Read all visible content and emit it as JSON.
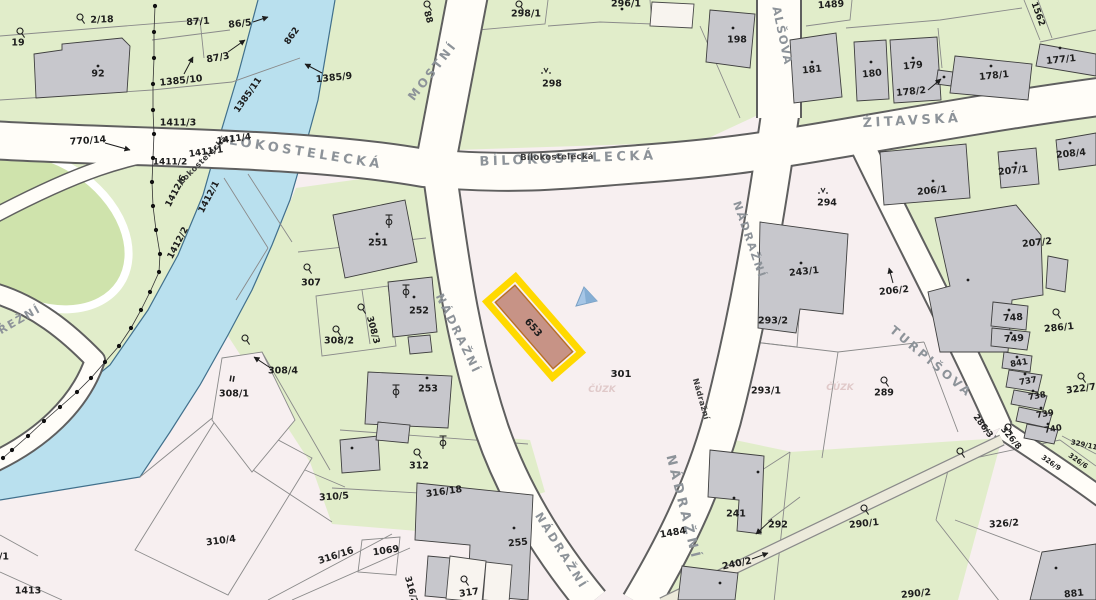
{
  "map": {
    "colors": {
      "background": "#f7eff0",
      "water": "#b9e0ee",
      "water_edge": "#41708c",
      "green_area": "#e1edca",
      "park_green": "#cfe3ac",
      "road_fill": "#fffdf8",
      "road_casing": "#5f5f5f",
      "building_gray": "#c7c7cc",
      "highlight_yellow": "#ffd900",
      "highlight_border": "#b86f28",
      "highlight_fill": "#c79386",
      "marker_blue": "#a6c6e6",
      "street_label": "#8d9399",
      "parcel_label": "#1d1d1d",
      "strip_fill": "#eceadb"
    },
    "highlight": {
      "label": "653",
      "x": 534,
      "y": 327,
      "rot": 49
    },
    "marker": {
      "x": 585,
      "y": 296
    },
    "streets": [
      {
        "text": "LOKOSTELECKÁ",
        "x": 306,
        "y": 153,
        "rot": 9,
        "size": 13,
        "sp": 3.5
      },
      {
        "text": "Lokostelecká",
        "x": 203,
        "y": 160,
        "rot": -45,
        "size": 8,
        "sp": 0.5,
        "dark": true
      },
      {
        "text": "BÍLOKOSTELECKÁ",
        "x": 568,
        "y": 159,
        "rot": -2,
        "size": 13,
        "sp": 3.5
      },
      {
        "text": "Bílokostelecká",
        "x": 557,
        "y": 157,
        "rot": -1,
        "size": 8.5,
        "sp": 0.3,
        "dark": true
      },
      {
        "text": "ŽITAVSKÁ",
        "x": 912,
        "y": 121,
        "rot": -3,
        "size": 13,
        "sp": 3.5
      },
      {
        "text": "MOSTNÍ",
        "x": 433,
        "y": 71,
        "rot": -52,
        "size": 12,
        "sp": 3
      },
      {
        "text": "NÁDRAŽNÍ",
        "x": 458,
        "y": 334,
        "rot": 64,
        "size": 11.5,
        "sp": 2.5
      },
      {
        "text": "NÁDRAŽNÍ",
        "x": 561,
        "y": 551,
        "rot": 58,
        "size": 11.5,
        "sp": 2.5
      },
      {
        "text": "NÁDRAŽNÍ",
        "x": 749,
        "y": 240,
        "rot": 71,
        "size": 11,
        "sp": 2
      },
      {
        "text": "NÁDRAŽNÍ",
        "x": 683,
        "y": 508,
        "rot": 76,
        "size": 13,
        "sp": 4
      },
      {
        "text": "Nádražní",
        "x": 701,
        "y": 399,
        "rot": 74,
        "size": 8,
        "sp": 0.3,
        "dark": true
      },
      {
        "text": "ALŠOVA",
        "x": 782,
        "y": 36,
        "rot": 78,
        "size": 11.5,
        "sp": 1.5
      },
      {
        "text": "TURPIŠOVA",
        "x": 931,
        "y": 362,
        "rot": 40,
        "size": 12,
        "sp": 3
      },
      {
        "text": "ŘEŽNÍ",
        "x": 20,
        "y": 320,
        "rot": -30,
        "size": 11,
        "sp": 2
      }
    ],
    "parcel_labels": [
      {
        "text": "2/18",
        "x": 102,
        "y": 20,
        "rot": -2
      },
      {
        "text": "19",
        "x": 18,
        "y": 43,
        "rot": 0
      },
      {
        "text": "92",
        "x": 98,
        "y": 74,
        "rot": 0
      },
      {
        "text": "87/1",
        "x": 198,
        "y": 22,
        "rot": -4
      },
      {
        "text": "86/5",
        "x": 240,
        "y": 24,
        "rot": -6
      },
      {
        "text": "87/3",
        "x": 218,
        "y": 58,
        "rot": -10
      },
      {
        "text": "1385/10",
        "x": 181,
        "y": 81,
        "rot": -6
      },
      {
        "text": "862",
        "x": 292,
        "y": 36,
        "rot": -55,
        "size": 9
      },
      {
        "text": "1385/9",
        "x": 334,
        "y": 78,
        "rot": -6
      },
      {
        "text": "1385/11",
        "x": 248,
        "y": 95,
        "rot": -55,
        "size": 9
      },
      {
        "text": "770/14",
        "x": 88,
        "y": 141,
        "rot": -4
      },
      {
        "text": "1411/3",
        "x": 178,
        "y": 123,
        "rot": 0
      },
      {
        "text": "1411/4",
        "x": 234,
        "y": 139,
        "rot": -8,
        "size": 9
      },
      {
        "text": "1411/1",
        "x": 206,
        "y": 152,
        "rot": -8,
        "size": 9
      },
      {
        "text": "1411/2",
        "x": 170,
        "y": 162,
        "rot": 0,
        "size": 9
      },
      {
        "text": "1412/6",
        "x": 176,
        "y": 191,
        "rot": -62,
        "size": 9
      },
      {
        "text": "1412/1",
        "x": 209,
        "y": 197,
        "rot": -62,
        "size": 9
      },
      {
        "text": "1412/2",
        "x": 178,
        "y": 243,
        "rot": -62,
        "size": 9
      },
      {
        "text": "88",
        "x": 428,
        "y": 17,
        "rot": 75,
        "size": 9
      },
      {
        "text": "298/1",
        "x": 526,
        "y": 14,
        "rot": 0
      },
      {
        "text": "296/1",
        "x": 626,
        "y": 4,
        "rot": 0
      },
      {
        "text": "298",
        "x": 552,
        "y": 84,
        "rot": 0
      },
      {
        "text": "1489",
        "x": 831,
        "y": 5,
        "rot": -4
      },
      {
        "text": "198",
        "x": 737,
        "y": 40,
        "rot": 0
      },
      {
        "text": "181",
        "x": 812,
        "y": 70,
        "rot": -6
      },
      {
        "text": "180",
        "x": 872,
        "y": 74,
        "rot": -6
      },
      {
        "text": "179",
        "x": 913,
        "y": 66,
        "rot": -6
      },
      {
        "text": "178/2",
        "x": 911,
        "y": 92,
        "rot": -6
      },
      {
        "text": "178/1",
        "x": 994,
        "y": 76,
        "rot": -6
      },
      {
        "text": "177/1",
        "x": 1061,
        "y": 60,
        "rot": -6
      },
      {
        "text": "1562",
        "x": 1038,
        "y": 14,
        "rot": 70,
        "size": 9
      },
      {
        "text": "208/4",
        "x": 1071,
        "y": 154,
        "rot": -6
      },
      {
        "text": "207/1",
        "x": 1013,
        "y": 171,
        "rot": -6
      },
      {
        "text": "206/1",
        "x": 932,
        "y": 191,
        "rot": -6
      },
      {
        "text": "207/2",
        "x": 1037,
        "y": 243,
        "rot": -6
      },
      {
        "text": "294",
        "x": 827,
        "y": 203,
        "rot": 0
      },
      {
        "text": "243/1",
        "x": 804,
        "y": 272,
        "rot": -6
      },
      {
        "text": "206/2",
        "x": 894,
        "y": 291,
        "rot": -6
      },
      {
        "text": "293/2",
        "x": 773,
        "y": 321,
        "rot": 0
      },
      {
        "text": "301",
        "x": 621,
        "y": 374,
        "rot": 0,
        "size": 10
      },
      {
        "text": "307",
        "x": 311,
        "y": 283,
        "rot": 0
      },
      {
        "text": "308/2",
        "x": 339,
        "y": 341,
        "rot": 0
      },
      {
        "text": "308/3",
        "x": 373,
        "y": 330,
        "rot": 75,
        "size": 9
      },
      {
        "text": "252",
        "x": 419,
        "y": 311,
        "rot": 0
      },
      {
        "text": "308/4",
        "x": 283,
        "y": 371,
        "rot": 0
      },
      {
        "text": "308/1",
        "x": 234,
        "y": 394,
        "rot": 0
      },
      {
        "text": "II",
        "x": 232,
        "y": 379,
        "rot": 10,
        "size": 8
      },
      {
        "text": "251",
        "x": 378,
        "y": 243,
        "rot": 0
      },
      {
        "text": "253",
        "x": 428,
        "y": 389,
        "rot": 0
      },
      {
        "text": "312",
        "x": 419,
        "y": 466,
        "rot": 0
      },
      {
        "text": "310/5",
        "x": 334,
        "y": 497,
        "rot": -4
      },
      {
        "text": "316/18",
        "x": 444,
        "y": 492,
        "rot": -8
      },
      {
        "text": "310/4",
        "x": 221,
        "y": 541,
        "rot": -8
      },
      {
        "text": "316/16",
        "x": 336,
        "y": 556,
        "rot": -18
      },
      {
        "text": "1069",
        "x": 386,
        "y": 551,
        "rot": -8
      },
      {
        "text": "255",
        "x": 518,
        "y": 543,
        "rot": -6
      },
      {
        "text": "317",
        "x": 469,
        "y": 593,
        "rot": -8
      },
      {
        "text": "316/2",
        "x": 411,
        "y": 590,
        "rot": 75,
        "size": 9
      },
      {
        "text": "1413",
        "x": 28,
        "y": 591,
        "rot": 0
      },
      {
        "text": "309/1",
        "x": -6,
        "y": 557,
        "rot": 0
      },
      {
        "text": "293/1",
        "x": 766,
        "y": 391,
        "rot": 0
      },
      {
        "text": "289",
        "x": 884,
        "y": 393,
        "rot": 0
      },
      {
        "text": "290/1",
        "x": 864,
        "y": 524,
        "rot": -6
      },
      {
        "text": "292",
        "x": 778,
        "y": 525,
        "rot": 0
      },
      {
        "text": "240/2",
        "x": 737,
        "y": 564,
        "rot": -12
      },
      {
        "text": "241",
        "x": 736,
        "y": 514,
        "rot": 0
      },
      {
        "text": "1484",
        "x": 673,
        "y": 533,
        "rot": -10
      },
      {
        "text": "290/2",
        "x": 916,
        "y": 594,
        "rot": -6
      },
      {
        "text": "748",
        "x": 1013,
        "y": 318,
        "rot": -4
      },
      {
        "text": "749",
        "x": 1014,
        "y": 339,
        "rot": -4
      },
      {
        "text": "841",
        "x": 1019,
        "y": 363,
        "rot": -10,
        "size": 8.5
      },
      {
        "text": "737",
        "x": 1028,
        "y": 381,
        "rot": -10,
        "size": 8.5
      },
      {
        "text": "738",
        "x": 1037,
        "y": 396,
        "rot": -10,
        "size": 8.5
      },
      {
        "text": "739",
        "x": 1045,
        "y": 414,
        "rot": -10,
        "size": 8.5
      },
      {
        "text": "740",
        "x": 1053,
        "y": 429,
        "rot": -10,
        "size": 8.5
      },
      {
        "text": "286/1",
        "x": 1059,
        "y": 328,
        "rot": -6
      },
      {
        "text": "322/7",
        "x": 1081,
        "y": 389,
        "rot": -8
      },
      {
        "text": "286/3",
        "x": 983,
        "y": 426,
        "rot": 53,
        "size": 8.5
      },
      {
        "text": "326/8",
        "x": 1011,
        "y": 438,
        "rot": 50,
        "size": 8.5
      },
      {
        "text": "329/11",
        "x": 1084,
        "y": 445,
        "rot": 12,
        "size": 7
      },
      {
        "text": "326/9",
        "x": 1051,
        "y": 463,
        "rot": 35,
        "size": 7
      },
      {
        "text": "326/6",
        "x": 1078,
        "y": 461,
        "rot": 35,
        "size": 7
      },
      {
        "text": "326/2",
        "x": 1004,
        "y": 524,
        "rot": -4
      },
      {
        "text": "881",
        "x": 1074,
        "y": 594,
        "rot": -6
      }
    ],
    "watermarks": [
      {
        "text": "ČÚZK",
        "x": 602,
        "y": 392
      },
      {
        "text": "ČÚZK",
        "x": 840,
        "y": 390
      }
    ],
    "symbols": [
      {
        "type": "yard",
        "x": 80,
        "y": 17
      },
      {
        "type": "yard",
        "x": 20,
        "y": 31
      },
      {
        "type": "yard",
        "x": 519,
        "y": 4
      },
      {
        "type": "yard",
        "x": 427,
        "y": 4
      },
      {
        "type": "yard",
        "x": 307,
        "y": 267
      },
      {
        "type": "yard",
        "x": 336,
        "y": 329
      },
      {
        "type": "yard",
        "x": 361,
        "y": 307
      },
      {
        "type": "yard",
        "x": 417,
        "y": 452
      },
      {
        "type": "yard",
        "x": 464,
        "y": 579
      },
      {
        "type": "yard",
        "x": 884,
        "y": 380
      },
      {
        "type": "yard",
        "x": 864,
        "y": 508
      },
      {
        "type": "yard",
        "x": 1056,
        "y": 312
      },
      {
        "type": "yard",
        "x": 1081,
        "y": 376
      },
      {
        "type": "yard",
        "x": 1008,
        "y": 427
      },
      {
        "type": "yard",
        "x": 960,
        "y": 451
      },
      {
        "type": "yard",
        "x": 245,
        "y": 338
      },
      {
        "type": "cross",
        "x": 389,
        "y": 222
      },
      {
        "type": "cross",
        "x": 406,
        "y": 292
      },
      {
        "type": "cross",
        "x": 396,
        "y": 392
      },
      {
        "type": "cross",
        "x": 443,
        "y": 443
      },
      {
        "type": "tree",
        "x": 546,
        "y": 72
      },
      {
        "type": "tree",
        "x": 823,
        "y": 192
      }
    ],
    "building_dots": [
      [
        98,
        66
      ],
      [
        733,
        28
      ],
      [
        812,
        62
      ],
      [
        871,
        62
      ],
      [
        913,
        58
      ],
      [
        991,
        66
      ],
      [
        1060,
        48
      ],
      [
        933,
        181
      ],
      [
        1016,
        163
      ],
      [
        1070,
        143
      ],
      [
        801,
        263
      ],
      [
        758,
        472
      ],
      [
        734,
        498
      ],
      [
        720,
        583
      ],
      [
        514,
        528
      ],
      [
        427,
        378
      ],
      [
        414,
        297
      ],
      [
        377,
        234
      ],
      [
        1009,
        310
      ],
      [
        1011,
        333
      ],
      [
        1017,
        357
      ],
      [
        1025,
        374
      ],
      [
        1033,
        391
      ],
      [
        1041,
        408
      ],
      [
        1048,
        424
      ],
      [
        968,
        280
      ],
      [
        1056,
        568
      ],
      [
        352,
        448
      ],
      [
        622,
        9
      ],
      [
        944,
        77
      ]
    ],
    "boundary_dots": [
      [
        155,
        6
      ],
      [
        154,
        32
      ],
      [
        154,
        58
      ],
      [
        153,
        84
      ],
      [
        153,
        110
      ],
      [
        154,
        134
      ],
      [
        153,
        158
      ],
      [
        152,
        182
      ],
      [
        153,
        206
      ],
      [
        156,
        230
      ],
      [
        160,
        254
      ],
      [
        159,
        272
      ],
      [
        150,
        292
      ],
      [
        141,
        310
      ],
      [
        131,
        328
      ],
      [
        119,
        346
      ],
      [
        105,
        362
      ],
      [
        91,
        378
      ],
      [
        77,
        392
      ],
      [
        60,
        407
      ],
      [
        44,
        421
      ],
      [
        28,
        436
      ],
      [
        12,
        450
      ],
      [
        3,
        458
      ]
    ],
    "arrows": [
      {
        "x1": 105,
        "y1": 143,
        "x2": 130,
        "y2": 150
      },
      {
        "x1": 253,
        "y1": 22,
        "x2": 268,
        "y2": 17
      },
      {
        "x1": 228,
        "y1": 52,
        "x2": 245,
        "y2": 40
      },
      {
        "x1": 184,
        "y1": 74,
        "x2": 193,
        "y2": 57
      },
      {
        "x1": 322,
        "y1": 73,
        "x2": 305,
        "y2": 64
      },
      {
        "x1": 928,
        "y1": 90,
        "x2": 941,
        "y2": 79
      },
      {
        "x1": 893,
        "y1": 283,
        "x2": 889,
        "y2": 268
      },
      {
        "x1": 772,
        "y1": 519,
        "x2": 756,
        "y2": 534
      },
      {
        "x1": 269,
        "y1": 367,
        "x2": 254,
        "y2": 357
      },
      {
        "x1": 752,
        "y1": 559,
        "x2": 768,
        "y2": 553
      }
    ]
  }
}
